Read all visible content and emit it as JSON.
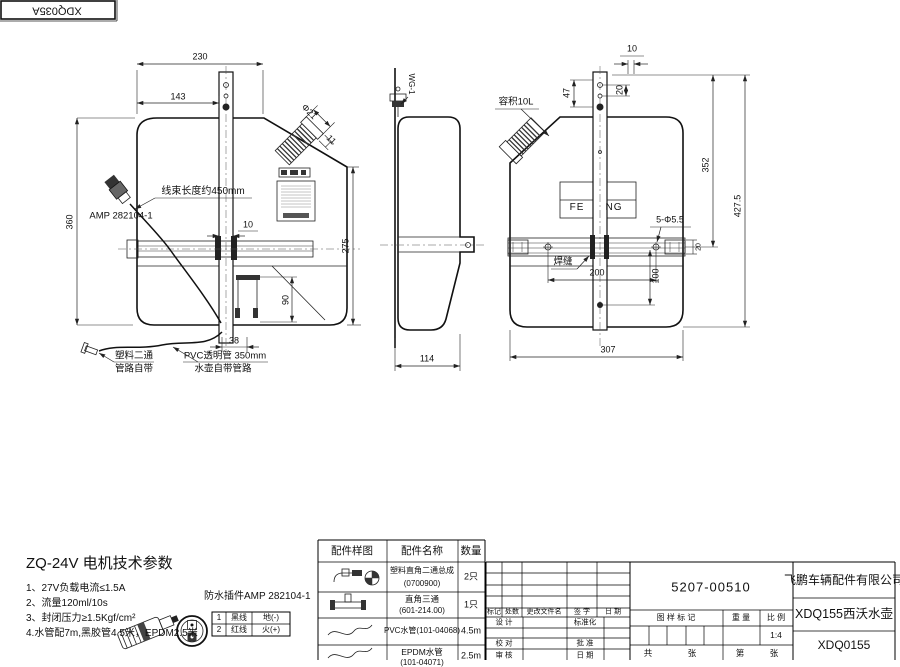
{
  "stamp": {
    "code": "XDQ035A"
  },
  "front_view": {
    "dim_230": "230",
    "dim_143": "143",
    "dim_360": "360",
    "dim_275": "275",
    "dim_90": "90",
    "dim_38": "38",
    "dim_10": "10",
    "dim_phi21": "Φ21",
    "dim_11": "11",
    "harness_note": "线束长度约450mm",
    "amp_label": "AMP 282104-1",
    "fitting_note_line1": "塑料二通",
    "fitting_note_line2": "管路自带",
    "pvc_note_line1": "PVC透明管 350mm",
    "pvc_note_line2": "水壶自带管路"
  },
  "side_view": {
    "dim_114": "114",
    "pump_label": "WG-1"
  },
  "rear_view": {
    "capacity_note": "容积10L",
    "dim_10": "10",
    "dim_47": "47",
    "dim_20": "20",
    "dim_352": "352",
    "dim_427_5": "427.5",
    "holes_note": "5-Φ5.5",
    "weld_note": "焊缝",
    "dim_200": "200",
    "dim_100": "100",
    "dim_307": "307",
    "dim_20b": "20",
    "brand_left": "FE",
    "brand_right": "NG"
  },
  "motor_specs": {
    "title": "ZQ-24V 电机技术参数",
    "items": [
      "1、27V负载电流≤1.5A",
      "2、流量120ml/10s",
      "3、封闭压力≥1.5Kgf/cm²",
      "4.水管配7m,黑胶管4.5米，EPDM2.5米"
    ],
    "connector_note": "防水插件AMP 282104-1",
    "pin_table": {
      "rows": [
        {
          "no": "1",
          "wire": "黑线",
          "polarity": "地(-)"
        },
        {
          "no": "2",
          "wire": "红线",
          "polarity": "火(+)"
        }
      ]
    }
  },
  "parts_table": {
    "headers": [
      "配件样图",
      "配件名称",
      "数量"
    ],
    "rows": [
      {
        "name_line1": "塑料直角二通总成",
        "name_line2": "(0700900)",
        "qty": "2只"
      },
      {
        "name_line1": "直角三通",
        "name_line2": "(601-214.00)",
        "qty": "1只"
      },
      {
        "name_line1": "PVC水管(101-04068)",
        "name_line2": "",
        "qty": "4.5m"
      },
      {
        "name_line1": "EPDM水管",
        "name_line2": "(101-04071)",
        "qty": "2.5m"
      }
    ]
  },
  "title_block": {
    "drawing_no": "5207-00510",
    "company": "飞鹏车辆配件有限公司",
    "product": "XDQ155西沃水壶",
    "code": "XDQ0155",
    "scale_value": "1:4",
    "labels": {
      "mark": "标记",
      "count": "处数",
      "file": "更改文件名",
      "sign": "签 字",
      "date": "日 期",
      "design": "设 计",
      "standard": "标准化",
      "check": "校 对",
      "approve": "批 准",
      "review": "审 核",
      "date2": "日 期",
      "drawing_mark": "图 样 标 记",
      "weight": "重 量",
      "scale": "比 例",
      "total": "共",
      "sheet1": "张",
      "page": "第",
      "sheet2": "张"
    }
  }
}
